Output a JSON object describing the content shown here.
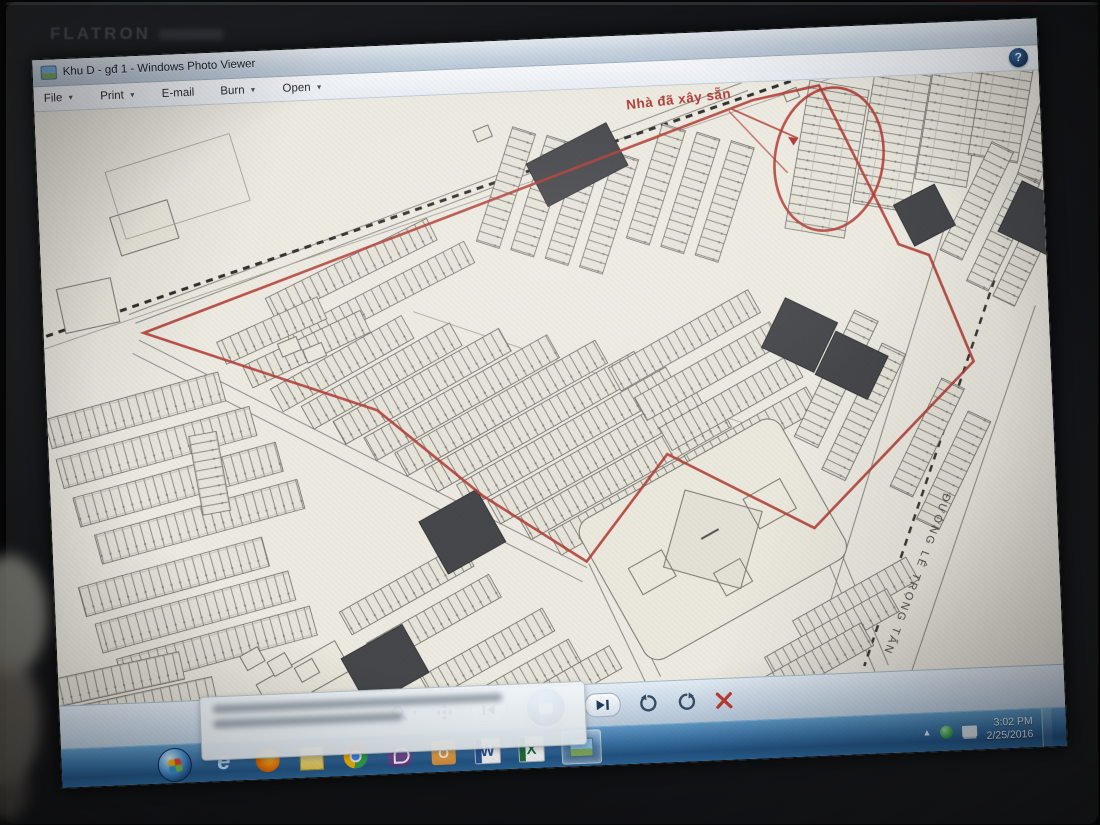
{
  "monitor": {
    "brand": "FLATRON"
  },
  "viewer": {
    "title": "Khu D - gđ 1 - Windows Photo Viewer",
    "help_glyph": "?",
    "menu": [
      {
        "label": "File",
        "caret": "▼"
      },
      {
        "label": "Print",
        "caret": "▼"
      },
      {
        "label": "E-mail"
      },
      {
        "label": "Burn",
        "caret": "▼"
      },
      {
        "label": "Open",
        "caret": "▼"
      }
    ],
    "toolbar": {
      "zoom_caret": "▼"
    }
  },
  "map": {
    "annotation": "Nhà đã xây sẵn",
    "street": "ĐƯỜNG LÊ TRỌNG TẤN",
    "accent_red": "#b23b33"
  },
  "taskbar": {
    "icons": [
      {
        "name": "internet-explorer",
        "glyph": "e"
      },
      {
        "name": "firefox"
      },
      {
        "name": "sticky-notes"
      },
      {
        "name": "chrome"
      },
      {
        "name": "viber"
      },
      {
        "name": "outlook",
        "glyph": "O"
      },
      {
        "name": "word",
        "glyph": "W"
      },
      {
        "name": "excel",
        "glyph": "X"
      },
      {
        "name": "photo-viewer-active"
      }
    ],
    "clock": {
      "time": "3:02 PM",
      "date": "2/25/2016"
    }
  }
}
